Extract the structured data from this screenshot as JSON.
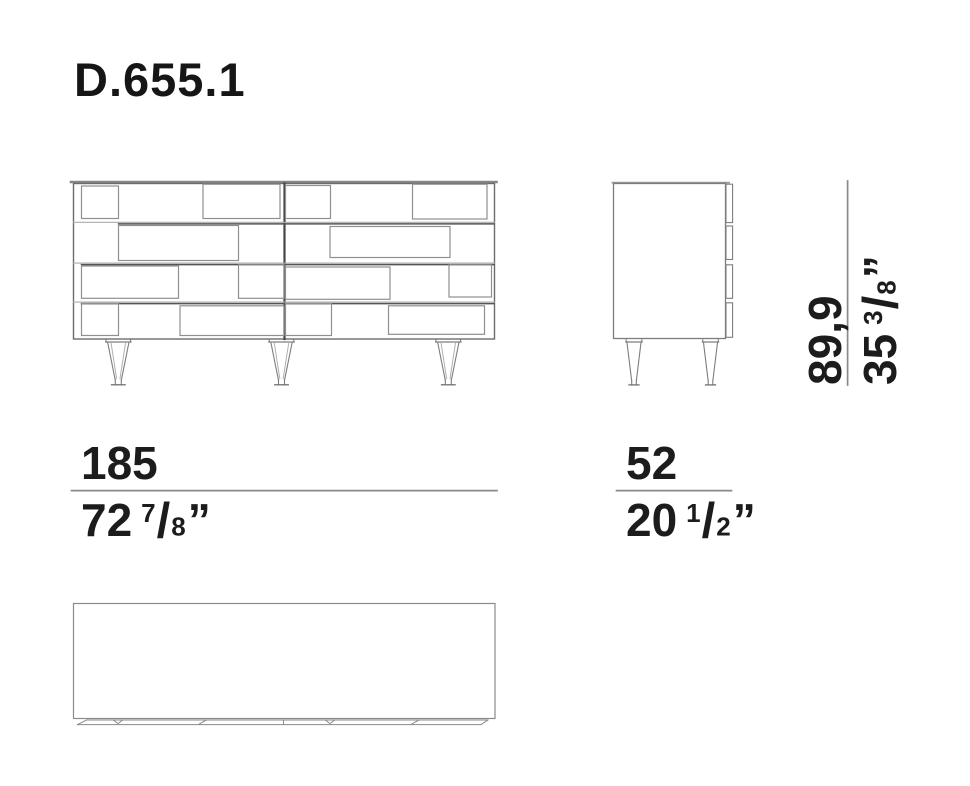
{
  "title": "D.655.1",
  "colors": {
    "background": "#ffffff",
    "text": "#1c1c1c",
    "line_light": "#ababab",
    "line_medium": "#8a8a8a",
    "line_dark": "#4f4f4f"
  },
  "dimensions": {
    "width": {
      "metric": "185",
      "imperial": {
        "whole": "72",
        "numerator": "7",
        "fraction_slash": "/",
        "denominator": "8",
        "unit_mark": "”"
      }
    },
    "depth": {
      "metric": "52",
      "imperial": {
        "whole": "20",
        "numerator": "1",
        "fraction_slash": "/",
        "denominator": "2",
        "unit_mark": "”"
      }
    },
    "height": {
      "metric": "89,9",
      "imperial": {
        "whole": "35",
        "numerator": "3",
        "fraction_slash": "/",
        "denominator": "8",
        "unit_mark": "”"
      }
    }
  }
}
